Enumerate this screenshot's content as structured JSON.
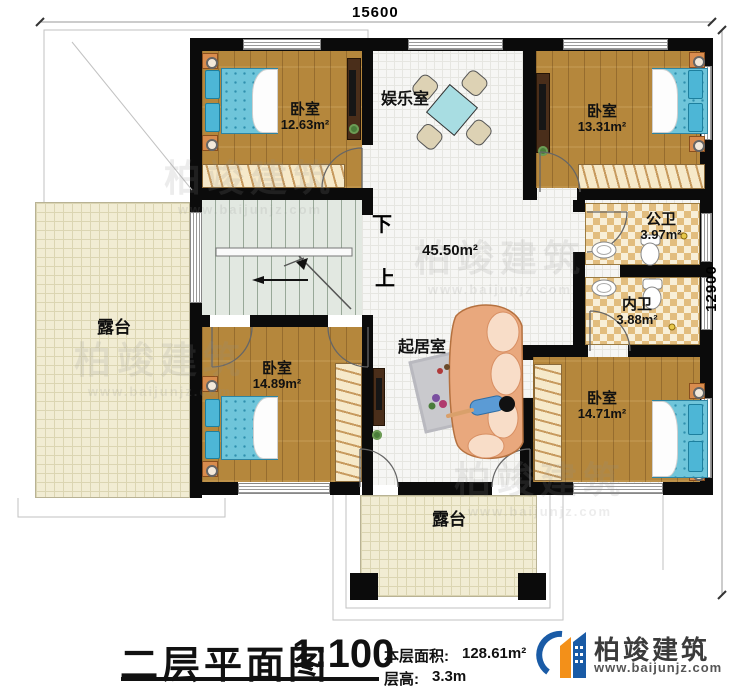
{
  "dimensions": {
    "top": "15600",
    "right": "12900"
  },
  "rooms": {
    "bedroom_tl": {
      "name": "卧室",
      "area": "12.63m²"
    },
    "entertainment": {
      "name": "娱乐室"
    },
    "bedroom_tr": {
      "name": "卧室",
      "area": "13.31m²"
    },
    "public_bath": {
      "name": "公卫",
      "area": "3.97m²"
    },
    "private_bath": {
      "name": "内卫",
      "area": "3.88m²"
    },
    "hall": {
      "area": "45.50m²"
    },
    "living": {
      "name": "起居室"
    },
    "bedroom_bl": {
      "name": "卧室",
      "area": "14.89m²"
    },
    "bedroom_br": {
      "name": "卧室",
      "area": "14.71m²"
    },
    "terrace_left": {
      "name": "露台"
    },
    "terrace_bottom": {
      "name": "露台"
    }
  },
  "stairs": {
    "down": "下",
    "up": "上"
  },
  "title": {
    "main": "二层平面图",
    "scale": "1:100",
    "floor_area_label": "本层面积:",
    "floor_area_value": "128.61m²",
    "floor_height_label": "层高:",
    "floor_height_value": "3.3m"
  },
  "logo": {
    "company": "柏竣建筑",
    "website": "www.baijunjz.com"
  },
  "watermark": {
    "company": "柏竣建筑",
    "website": "www.baijunjz.com"
  },
  "colors": {
    "wall": "#0b0b0b",
    "wood_floor": "#b5873c",
    "bed": "#6fc5da",
    "terrace": "#f1ecd3",
    "bath_tile": "#e2bd7e",
    "stairs": "#e2e8e1",
    "logo_blue": "#1a5ba6",
    "logo_orange": "#f39019"
  }
}
